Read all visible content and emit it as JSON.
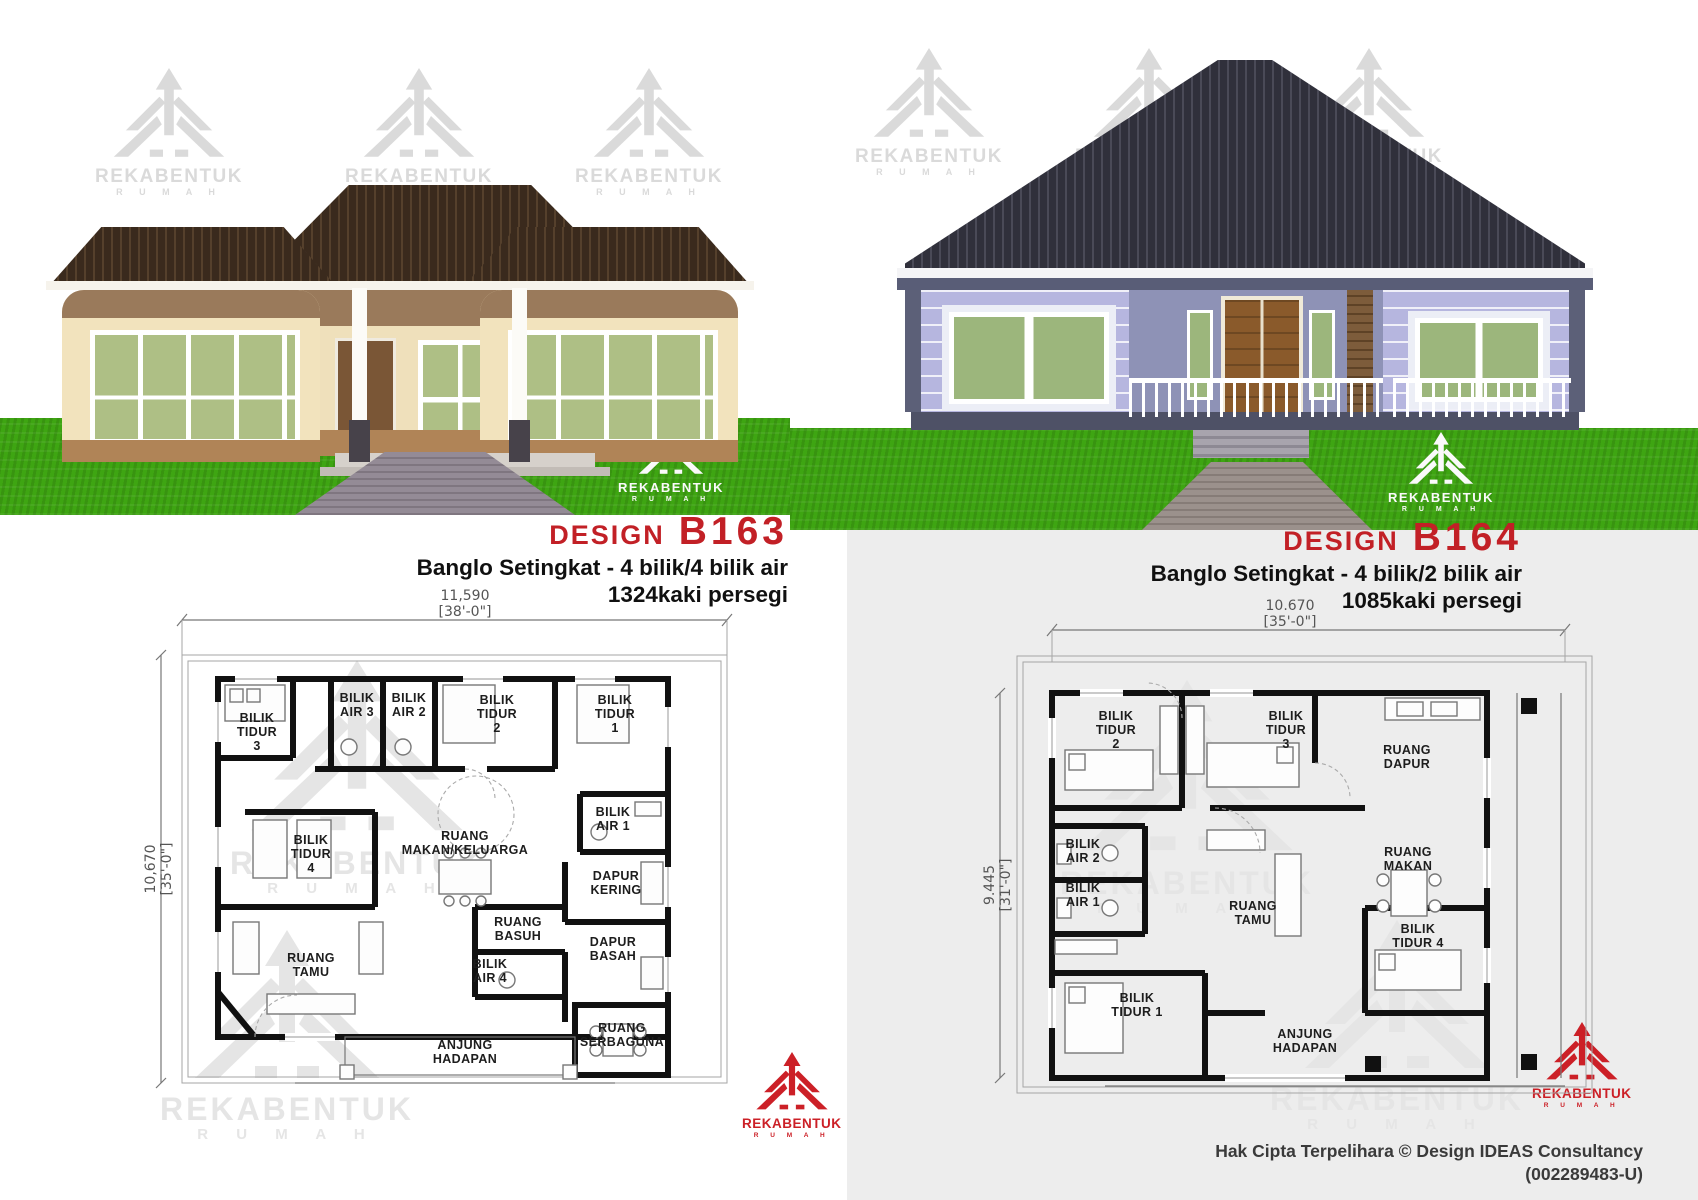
{
  "brand": {
    "name": "REKABENTUK",
    "sub": "R U M A H"
  },
  "designs": {
    "b163": {
      "design_word": "DESIGN",
      "code": "B163",
      "subtitle": "Banglo Setingkat - 4 bilik/4 bilik air",
      "area": "1324kaki persegi",
      "dims": {
        "top_mm": "11,590",
        "top_ft": "[38'-0\"]",
        "left_mm": "10,670",
        "left_ft": "[35'-0\"]"
      },
      "rooms": {
        "bt3": {
          "name": "BILIK TIDUR 3",
          "lines": [
            "BILIK",
            "TIDUR",
            "3"
          ]
        },
        "ba3": {
          "name": "BILIK AIR 3",
          "lines": [
            "BILIK",
            "AIR 3"
          ]
        },
        "ba2": {
          "name": "BILIK AIR 2",
          "lines": [
            "BILIK",
            "AIR 2"
          ]
        },
        "bt2": {
          "name": "BILIK TIDUR 2",
          "lines": [
            "BILIK",
            "TIDUR",
            "2"
          ]
        },
        "bt1": {
          "name": "BILIK TIDUR 1",
          "lines": [
            "BILIK",
            "TIDUR",
            "1"
          ]
        },
        "ba1": {
          "name": "BILIK AIR 1",
          "lines": [
            "BILIK",
            "AIR 1"
          ]
        },
        "bt4": {
          "name": "BILIK TIDUR 4",
          "lines": [
            "BILIK",
            "TIDUR",
            "4"
          ]
        },
        "rmk": {
          "name": "RUANG MAKAN/KELUARGA",
          "lines": [
            "RUANG",
            "MAKAN/KELUARGA"
          ]
        },
        "dk": {
          "name": "DAPUR KERING",
          "lines": [
            "DAPUR",
            "KERING"
          ]
        },
        "rb": {
          "name": "RUANG BASUH",
          "lines": [
            "RUANG",
            "BASUH"
          ]
        },
        "db": {
          "name": "DAPUR BASAH",
          "lines": [
            "DAPUR",
            "BASAH"
          ]
        },
        "ba4": {
          "name": "BILIK AIR 4",
          "lines": [
            "BILIK",
            "AIR 4"
          ]
        },
        "tamu": {
          "name": "RUANG TAMU",
          "lines": [
            "RUANG",
            "TAMU"
          ]
        },
        "anjung": {
          "name": "ANJUNG HADAPAN",
          "lines": [
            "ANJUNG",
            "HADAPAN"
          ]
        },
        "serba": {
          "name": "RUANG SERBAGUNA",
          "lines": [
            "RUANG",
            "SERBAGUNA"
          ]
        }
      }
    },
    "b164": {
      "design_word": "DESIGN",
      "code": "B164",
      "subtitle": "Banglo Setingkat - 4 bilik/2 bilik air",
      "area": "1085kaki persegi",
      "dims": {
        "top_mm": "10.670",
        "top_ft": "[35'-0\"]",
        "left_mm": "9.445",
        "left_ft": "[31'-0\"]"
      },
      "rooms": {
        "bt2": {
          "name": "BILIK TIDUR 2",
          "lines": [
            "BILIK",
            "TIDUR",
            "2"
          ]
        },
        "bt3": {
          "name": "BILIK TIDUR 3",
          "lines": [
            "BILIK",
            "TIDUR",
            "3"
          ]
        },
        "dapur": {
          "name": "RUANG DAPUR",
          "lines": [
            "RUANG",
            "DAPUR"
          ]
        },
        "ba2": {
          "name": "BILIK AIR 2",
          "lines": [
            "BILIK",
            "AIR 2"
          ]
        },
        "ba1": {
          "name": "BILIK AIR 1",
          "lines": [
            "BILIK",
            "AIR 1"
          ]
        },
        "tamu": {
          "name": "RUANG TAMU",
          "lines": [
            "RUANG",
            "TAMU"
          ]
        },
        "makan": {
          "name": "RUANG MAKAN",
          "lines": [
            "RUANG",
            "MAKAN"
          ]
        },
        "bt4": {
          "name": "BILIK TIDUR 4",
          "lines": [
            "BILIK",
            "TIDUR 4"
          ]
        },
        "bt1": {
          "name": "BILIK TIDUR 1",
          "lines": [
            "BILIK",
            "TIDUR 1"
          ]
        },
        "anjung": {
          "name": "ANJUNG HADAPAN",
          "lines": [
            "ANJUNG",
            "HADAPAN"
          ]
        }
      }
    }
  },
  "footer": {
    "copyright": "Hak Cipta Terpelihara  © Design IDEAS Consultancy",
    "reg_no": "(002289483-U)"
  },
  "colors": {
    "title_red": "#c22026",
    "logo_red": "#cc2027",
    "roof_b163": "#3f2e20",
    "wall_b163": "#f2e3bd",
    "roof_b164": "#3b3b47",
    "wall_b164": "#b6b6df",
    "grass": "#3ea512",
    "plan_wall": "#111111"
  }
}
